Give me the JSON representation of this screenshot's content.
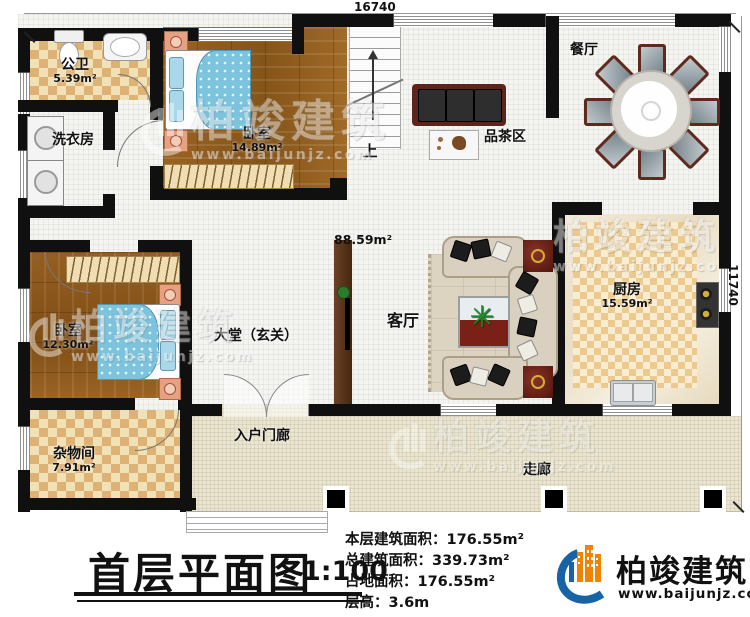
{
  "dimensions": {
    "top": "16740",
    "right": "11740"
  },
  "rooms": [
    {
      "name": "公卫",
      "area": "5.39m²"
    },
    {
      "name": "洗衣房",
      "area": ""
    },
    {
      "name": "卧室",
      "area": "14.89m²"
    },
    {
      "name": "餐厅",
      "area": ""
    },
    {
      "name": "品茶区",
      "area": ""
    },
    {
      "name": "厨房",
      "area": "15.59m²"
    },
    {
      "name": "客厅",
      "area": ""
    },
    {
      "name": "卧室",
      "area": "12.30m²"
    },
    {
      "name": "大堂（玄关）",
      "area": ""
    },
    {
      "name": "杂物间",
      "area": "7.91m²"
    },
    {
      "name": "入户门廊",
      "area": ""
    },
    {
      "name": "走廊",
      "area": ""
    }
  ],
  "annotations": {
    "up": "上",
    "hall_area": "88.59m²"
  },
  "title_block": {
    "title": "首层平面图",
    "scale": "1:100"
  },
  "stats": [
    {
      "label": "本层建筑面积：",
      "value": "176.55m²"
    },
    {
      "label": "总建筑面积：",
      "value": "339.73m²"
    },
    {
      "label": "占地面积：",
      "value": "176.55m²"
    },
    {
      "label": "层高：",
      "value": "3.6m"
    }
  ],
  "brand": {
    "name": "柏竣建筑",
    "url": "www.baijunjz.com"
  },
  "watermark": {
    "name": "柏竣建筑",
    "url": "www.baijunjz.com"
  },
  "colors": {
    "accent_blue": "#1663a5",
    "accent_orange": "#f08300",
    "wall": "#101010"
  }
}
